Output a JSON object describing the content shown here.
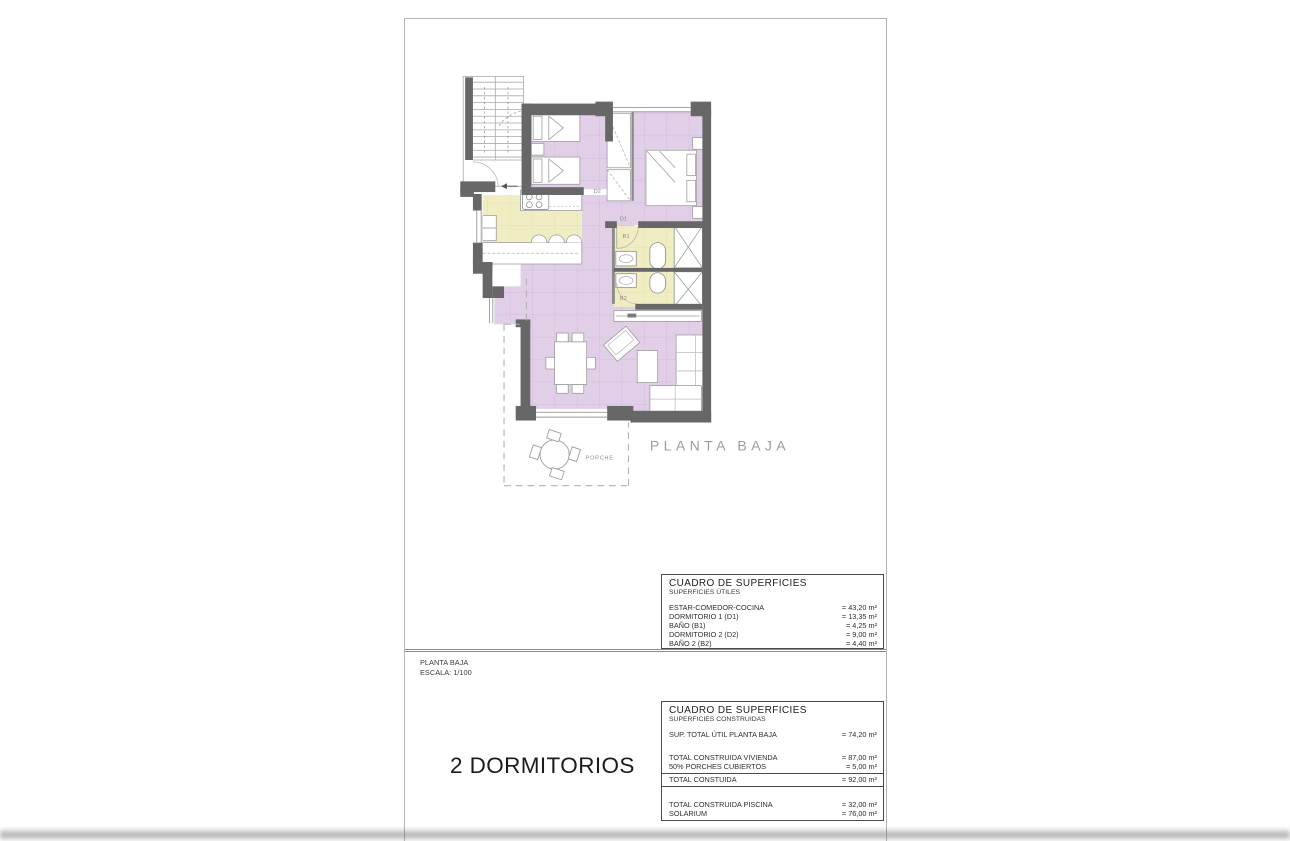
{
  "plan": {
    "title": "PLANTA BAJA",
    "room_labels": {
      "d1": "D1",
      "d2": "D2",
      "b1": "B1",
      "b2": "B2",
      "porch": "PORCHE"
    }
  },
  "surface_tables": {
    "utiles": {
      "title": "CUADRO DE SUPERFICIES",
      "subtitle": "SUPERFICIES ÚTILES",
      "rows": [
        {
          "label": "ESTAR-COMEDOR-COCINA",
          "value": "= 43,20 m²"
        },
        {
          "label": "DORMITORIO 1 (D1)",
          "value": "= 13,35 m²"
        },
        {
          "label": "BAÑO  (B1)",
          "value": "= 4,25 m²"
        },
        {
          "label": "DORMITORIO 2 (D2)",
          "value": "= 9,00 m²"
        },
        {
          "label": "BAÑO 2 (B2)",
          "value": "= 4,40 m²"
        }
      ]
    },
    "construidas": {
      "title": "CUADRO DE SUPERFICIES",
      "subtitle": "SUPERFICIES CONSTRUIDAS",
      "rows": [
        {
          "label": "SUP. TOTAL ÚTIL PLANTA BAJA",
          "value": "= 74,20 m²"
        },
        {
          "label": "TOTAL CONSTRUIDA VIVIENDA",
          "value": "= 87,00 m²"
        },
        {
          "label": "50% PORCHES CUBIERTOS",
          "value": "= 5,00 m²"
        },
        {
          "label": "TOTAL CONSTUIDA",
          "value": "= 92,00 m²"
        },
        {
          "label": "TOTAL CONSTRUIDA PISCINA",
          "value": "= 32,00 m²"
        },
        {
          "label": "SOLARIUM",
          "value": "= 76,00 m²"
        }
      ]
    }
  },
  "title_block": {
    "plan_name": "PLANTA BAJA",
    "scale": "ESCALA: 1/100"
  },
  "footer": {
    "type_label": "2 DORMITORIOS"
  },
  "colors": {
    "floor_purple": "#e1cfe8",
    "floor_yellow": "#f1edc2",
    "wall_gray": "#676767"
  }
}
